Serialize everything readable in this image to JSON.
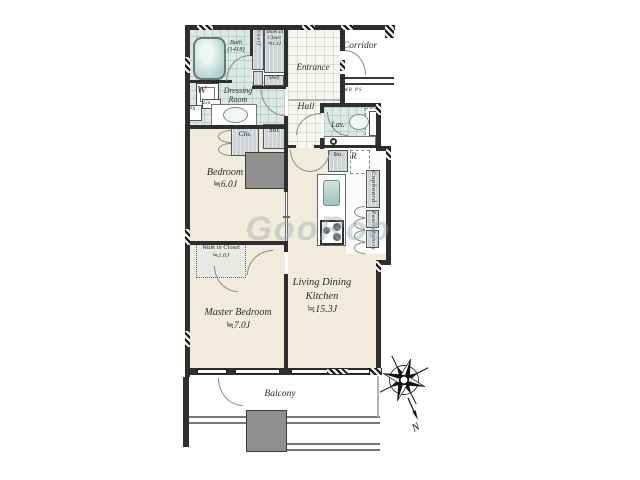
{
  "labels": {
    "corridor": "Corridor",
    "entrance": "Entrance",
    "hall": "Hall",
    "mb_ps": "MB PS",
    "bath": "Bath",
    "bath_size": "(1418)",
    "shelf_vertical": "Shelf",
    "shelf_horizontal": "Shelf",
    "shoes_closet_1": "Shoes in",
    "shoes_closet_2": "Closet",
    "shoes_closet_size": "≒1.1J",
    "washer": "W",
    "dressing_1": "Dressing",
    "dressing_2": "Room",
    "ps": "PS",
    "lin": "Lin.",
    "lav": "Lav.",
    "clo": "Clo.",
    "sto_hall": "Sto.",
    "sto_kitchen": "Sto.",
    "fridge": "R",
    "cupboard": "Cupboard",
    "pantry_upper": "Pantry",
    "pantry_lower": "Pantry",
    "bedroom": "Bedroom",
    "bedroom_size": "≒6.0J",
    "walkin_1": "Walk in",
    "walkin_2": "Closet",
    "walkin_size": "≒1.0J",
    "master_bedroom": "Master Bedroom",
    "master_bedroom_size": "≒7.0J",
    "ldk_1": "Living Dining",
    "ldk_2": "Kitchen",
    "ldk_size": "≒15.3J",
    "balcony": "Balcony"
  },
  "compass": {
    "north": "N"
  },
  "watermark": {
    "text": "GooRoo"
  },
  "colors": {
    "wall": "#2e2e2e",
    "floor": "#f1ebdb",
    "wet_area": "#dce8e2",
    "tile": "#f7f7f4",
    "fixture": "#cdd2d4",
    "pillar": "#8f8f8f",
    "tub": "#b9d6d0",
    "arc_line": "#8a8a8a",
    "watermark": "#8fa6b0"
  }
}
